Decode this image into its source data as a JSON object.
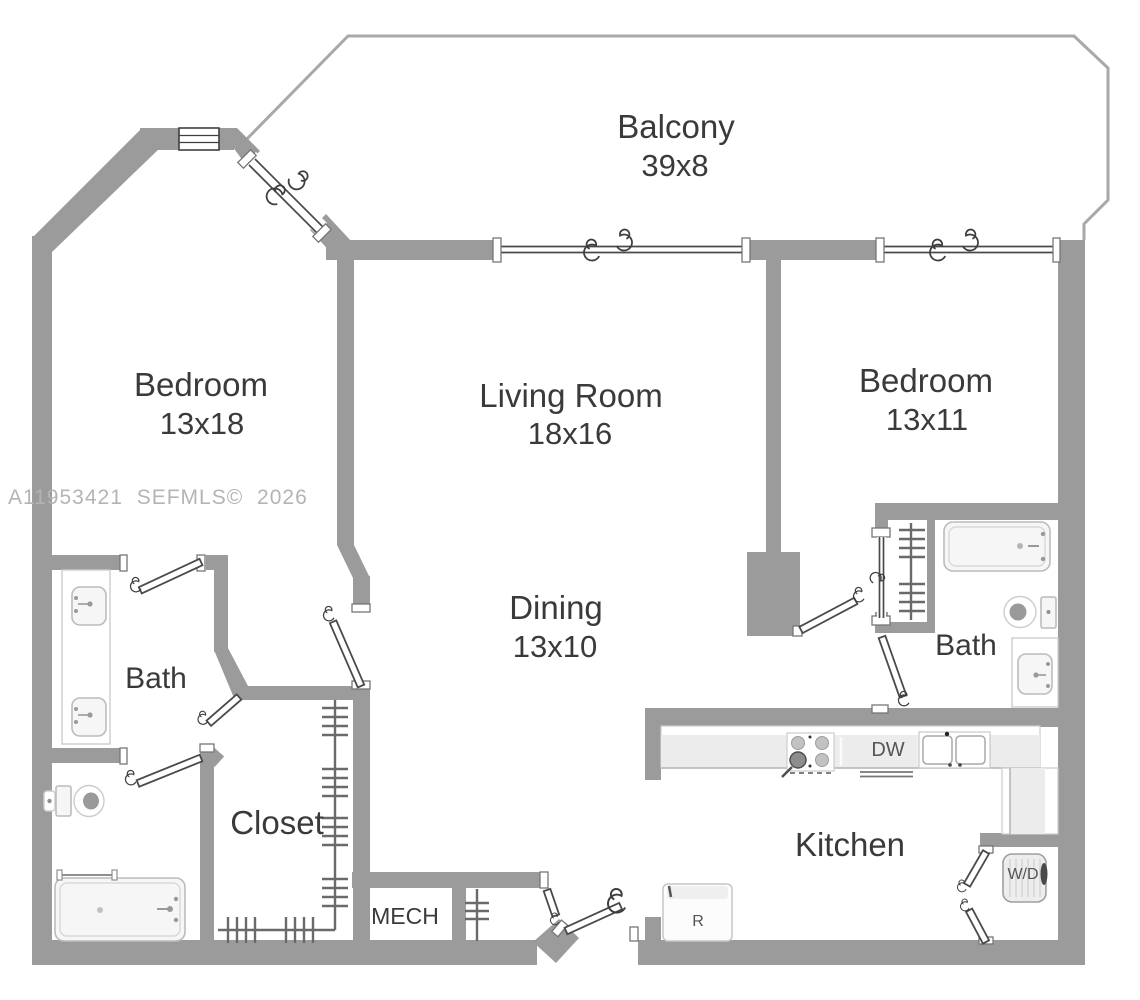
{
  "watermark": "A11953421 SEFMLS© 2026",
  "rooms": {
    "balcony": {
      "name": "Balcony",
      "dims": "39x8"
    },
    "bedroom_left": {
      "name": "Bedroom",
      "dims": "13x18"
    },
    "living": {
      "name": "Living Room",
      "dims": "18x16"
    },
    "bedroom_right": {
      "name": "Bedroom",
      "dims": "13x11"
    },
    "dining": {
      "name": "Dining",
      "dims": "13x10"
    },
    "bath_left": {
      "name": "Bath"
    },
    "bath_right": {
      "name": "Bath"
    },
    "closet": {
      "name": "Closet"
    },
    "mech": {
      "name": "MECH"
    },
    "kitchen": {
      "name": "Kitchen"
    }
  },
  "appliances": {
    "dishwasher": "DW",
    "refrigerator": "R",
    "washer_dryer": "W/D"
  },
  "colors": {
    "wall": "#9b9b9b",
    "balcony_outline": "#a8a8a8",
    "label": "#3a3a3a",
    "muted_label": "#555555",
    "watermark": "#b4b4b4",
    "fixture_stroke": "#bcbcbc",
    "fixture_fill": "#f6f6f6",
    "counter": "#ececec",
    "door_stroke": "#4a4a4a"
  }
}
